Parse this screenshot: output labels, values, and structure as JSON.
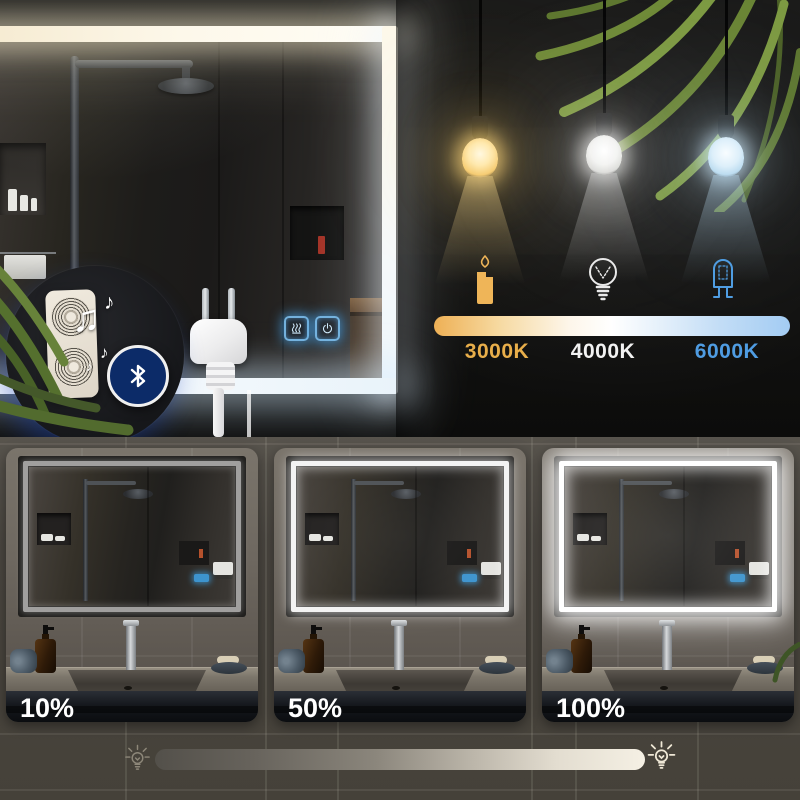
{
  "color_temperature": {
    "options": [
      {
        "label": "3000K",
        "icon": "candle-icon",
        "color": "#e8ae4a"
      },
      {
        "label": "4000K",
        "icon": "incandescent-bulb-icon",
        "color": "#f2f2f2"
      },
      {
        "label": "6000K",
        "icon": "halogen-bulb-icon",
        "color": "#4f9ce2"
      }
    ],
    "bar_gradient": [
      "#eeb055",
      "#ffffff",
      "#a3ccf3"
    ]
  },
  "pendant_bulbs": [
    {
      "name": "warm-bulb",
      "glow_color": "#f6cc72"
    },
    {
      "name": "neutral-bulb",
      "glow_color": "#ffffff"
    },
    {
      "name": "cool-bulb",
      "glow_color": "#cde8fa"
    }
  ],
  "features": {
    "bluetooth": {
      "icon": "bluetooth-icon",
      "badge_color": "#0c2b68"
    },
    "speaker": {
      "icon": "speaker-grille-icon"
    },
    "music": {
      "icon": "music-notes-icon",
      "notes": [
        "♫",
        "♪",
        "♪",
        "♪"
      ]
    },
    "touch_controls": [
      {
        "icon": "defog-icon",
        "glow_color": "#5fb6f0"
      },
      {
        "icon": "power-icon",
        "glow_color": "#5fb6f0"
      }
    ],
    "plug": {
      "icon": "eu-power-plug-icon"
    }
  },
  "dimming": {
    "levels": [
      {
        "label": "10%"
      },
      {
        "label": "50%"
      },
      {
        "label": "100%"
      }
    ],
    "slider": {
      "left_icon": "bulb-dim-icon",
      "right_icon": "bulb-bright-icon",
      "gradient": [
        "#57534c",
        "#f4efe3"
      ]
    }
  }
}
